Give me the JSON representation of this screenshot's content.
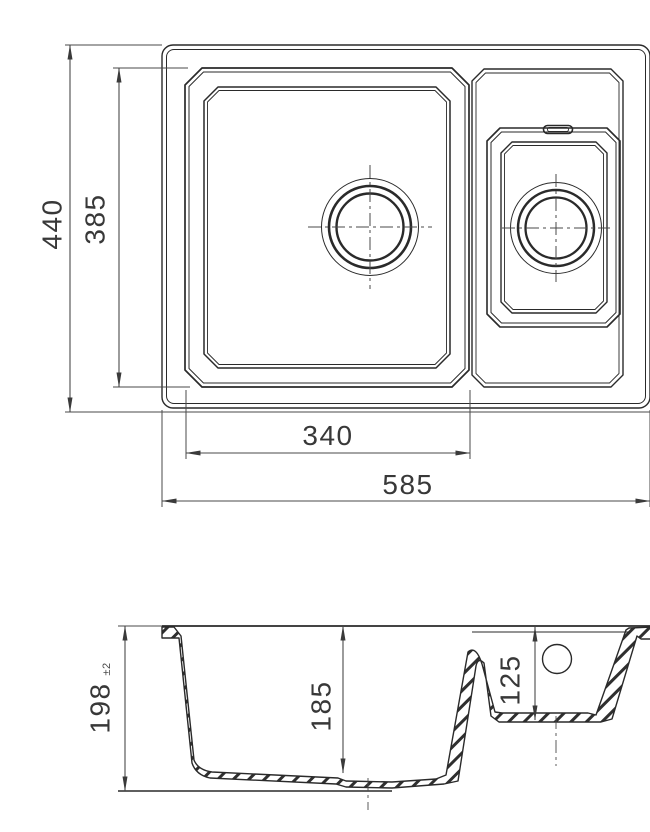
{
  "colors": {
    "background": "#ffffff",
    "line": "#2a2a2a",
    "dimension": "#4a4a4a"
  },
  "plan": {
    "dims": {
      "overall_depth": "440",
      "main_bowl_depth": "385",
      "main_bowl_width": "340",
      "overall_width": "585"
    }
  },
  "section": {
    "dims": {
      "overall_height": "198",
      "overall_height_tolerance": "±2",
      "main_bowl_depth": "185",
      "second_bowl_depth": "125"
    }
  }
}
